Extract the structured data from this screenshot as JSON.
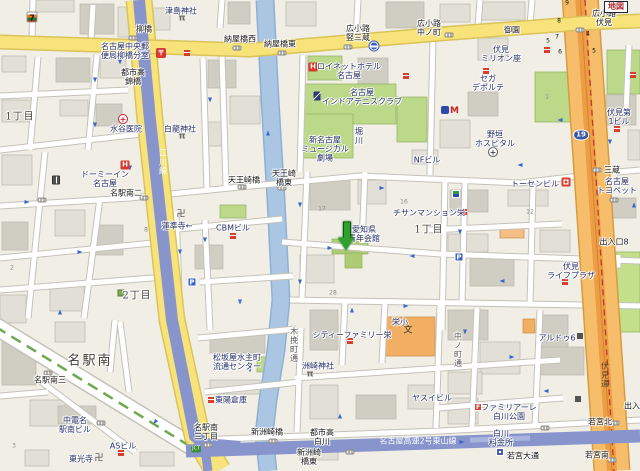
{
  "map": {
    "type": "japanese-street-map",
    "colors": {
      "background": "#F1EEE6",
      "building": "#E2E0D6",
      "building_dark": "#D0CEC3",
      "road_major_yellow": "#F8E27A",
      "road_route19_orange": "#F6BE6A",
      "road_route19_core": "#EE9D45",
      "river_blue": "#ABC6E2",
      "expressway_blue": "#8795CC",
      "park_green": "#BCD98A",
      "school_orange": "#F2AE62",
      "marker_green": "#2FA12F",
      "boundary_red": "#C0392B",
      "oneway_arrow_blue": "#3A66CC"
    },
    "marker": {
      "x": 347,
      "y": 237,
      "points_to": "愛知県青年会館"
    },
    "labels": [
      {
        "t": "1丁目",
        "x": 20,
        "y": 117,
        "c": "area"
      },
      {
        "t": "2丁目",
        "x": 137,
        "y": 296,
        "c": "area"
      },
      {
        "t": "名駅南",
        "x": 90,
        "y": 361,
        "c": "area-lg"
      },
      {
        "t": "1丁目",
        "x": 429,
        "y": 230,
        "c": "area"
      },
      {
        "t": "柳橋",
        "x": 144,
        "y": 29,
        "c": "xing"
      },
      {
        "t": "納屋橋西",
        "x": 240,
        "y": 39,
        "c": "xing"
      },
      {
        "t": "納屋橋東",
        "x": 280,
        "y": 44,
        "c": "xing"
      },
      {
        "t": "広小路\n竪三蔵",
        "x": 358,
        "y": 33,
        "c": "xing"
      },
      {
        "t": "広小路\n中ノ町",
        "x": 429,
        "y": 28,
        "c": "xing"
      },
      {
        "t": "広小路\n伏見",
        "x": 604,
        "y": 18,
        "c": "xing"
      },
      {
        "t": "御園",
        "x": 512,
        "y": 30,
        "c": "xing"
      },
      {
        "t": "名駅南二",
        "x": 126,
        "y": 193,
        "c": "xing"
      },
      {
        "t": "天王崎橋",
        "x": 244,
        "y": 180,
        "c": "xing"
      },
      {
        "t": "天王崎\n橋東",
        "x": 284,
        "y": 178,
        "c": "xing"
      },
      {
        "t": "三蔵",
        "x": 612,
        "y": 170,
        "c": "xing"
      },
      {
        "t": "名駅南三",
        "x": 50,
        "y": 380,
        "c": "xing"
      },
      {
        "t": "名駅南\n三丁目",
        "x": 206,
        "y": 432,
        "c": "xing"
      },
      {
        "t": "新洲崎橋",
        "x": 267,
        "y": 432,
        "c": "xing"
      },
      {
        "t": "新洲崎\n橋東",
        "x": 309,
        "y": 457,
        "c": "xing"
      },
      {
        "t": "若宮北",
        "x": 600,
        "y": 422,
        "c": "xing"
      },
      {
        "t": "若宮南",
        "x": 597,
        "y": 455,
        "c": "xing"
      },
      {
        "t": "出入口8",
        "x": 614,
        "y": 242,
        "c": "xing"
      },
      {
        "t": "出入口",
        "x": 636,
        "y": 406,
        "c": "xing"
      },
      {
        "t": "若宮大通",
        "x": 523,
        "y": 456,
        "c": "xing"
      },
      {
        "t": "都市高\n白川",
        "x": 322,
        "y": 437,
        "c": "xing"
      },
      {
        "t": "都市高\n錦橋",
        "x": 133,
        "y": 77,
        "c": "xing"
      },
      {
        "t": "津島神社",
        "x": 181,
        "y": 11,
        "c": "poi"
      },
      {
        "t": "名古屋中央郵\n便局柳橋分室",
        "x": 125,
        "y": 51,
        "c": "poi"
      },
      {
        "t": "水谷医院",
        "x": 126,
        "y": 129,
        "c": "poi"
      },
      {
        "t": "白龍神社",
        "x": 180,
        "y": 129,
        "c": "poi"
      },
      {
        "t": "ドーミーイン\n名古屋",
        "x": 105,
        "y": 179,
        "c": "poi"
      },
      {
        "t": "蓮準寺←",
        "x": 177,
        "y": 226,
        "c": "poi"
      },
      {
        "t": "CBMビル",
        "x": 233,
        "y": 228,
        "c": "poi"
      },
      {
        "t": "ロイネットホテル\n名古屋",
        "x": 349,
        "y": 71,
        "c": "poi"
      },
      {
        "t": "名古屋\nインドアテニスクラブ",
        "x": 362,
        "y": 97,
        "c": "poi"
      },
      {
        "t": "新名古屋\nミュージカル\n劇場",
        "x": 325,
        "y": 149,
        "c": "poi"
      },
      {
        "t": "NFビル",
        "x": 427,
        "y": 160,
        "c": "poi"
      },
      {
        "t": "チサンマンション栄",
        "x": 429,
        "y": 213,
        "c": "poi"
      },
      {
        "t": "愛知県\n青年会館",
        "x": 364,
        "y": 234,
        "c": "poi"
      },
      {
        "t": "伏見\nミリオン座",
        "x": 501,
        "y": 54,
        "c": "poi"
      },
      {
        "t": "セガ\nデポルテ",
        "x": 488,
        "y": 83,
        "c": "poi"
      },
      {
        "t": "野垣\nホスピタル",
        "x": 495,
        "y": 139,
        "c": "poi"
      },
      {
        "t": "伏見第\n1ビル",
        "x": 619,
        "y": 117,
        "c": "poi"
      },
      {
        "t": "名古屋\nトヨペット",
        "x": 617,
        "y": 186,
        "c": "poi"
      },
      {
        "t": "トーセンビル",
        "x": 535,
        "y": 184,
        "c": "poi"
      },
      {
        "t": "伏見\nライフプラザ",
        "x": 571,
        "y": 271,
        "c": "poi"
      },
      {
        "t": "ヤスイビル",
        "x": 432,
        "y": 398,
        "c": "poi"
      },
      {
        "t": "アルドゥ6",
        "x": 557,
        "y": 338,
        "c": "poi"
      },
      {
        "t": "ファミリアーレ\n白川公園",
        "x": 509,
        "y": 412,
        "c": "poi"
      },
      {
        "t": "シティーファミリー栄",
        "x": 352,
        "y": 335,
        "c": "poi"
      },
      {
        "t": "洲崎神社",
        "x": 318,
        "y": 366,
        "c": "poi"
      },
      {
        "t": "松坂屋水主町\n流通センター",
        "x": 237,
        "y": 362,
        "c": "poi"
      },
      {
        "t": "東陽倉庫",
        "x": 231,
        "y": 400,
        "c": "poi"
      },
      {
        "t": "東光寺",
        "x": 81,
        "y": 459,
        "c": "poi"
      },
      {
        "t": "ASビル",
        "x": 123,
        "y": 446,
        "c": "poi"
      },
      {
        "t": "中電名\n駅南ビル",
        "x": 75,
        "y": 425,
        "c": "poi"
      },
      {
        "t": "栄小",
        "x": 400,
        "y": 322,
        "c": "poi"
      },
      {
        "t": "白川\n料金所",
        "x": 501,
        "y": 438,
        "c": "poi"
      },
      {
        "t": "文",
        "x": 408,
        "y": 331,
        "c": "schoolsym"
      },
      {
        "t": "江川線",
        "x": 163,
        "y": 162,
        "c": "vroad-white"
      },
      {
        "t": "名古屋高速2号東山線",
        "x": 418,
        "y": 441,
        "c": "road-white"
      },
      {
        "t": "木挽町通",
        "x": 294,
        "y": 345,
        "c": "vroad"
      },
      {
        "t": "中ノ町通",
        "x": 458,
        "y": 350,
        "c": "vroad"
      },
      {
        "t": "伏見通",
        "x": 605,
        "y": 375,
        "c": "vroad-dk"
      },
      {
        "t": "堀川",
        "x": 359,
        "y": 136,
        "c": "vpoi"
      },
      {
        "t": "地図",
        "x": 616,
        "y": 7,
        "c": "mapbox"
      },
      {
        "t": "19",
        "x": 581,
        "y": 135,
        "c": "shield"
      },
      {
        "t": "JCT",
        "x": 196,
        "y": 449,
        "c": "jct"
      },
      {
        "t": "9",
        "x": 567,
        "y": 3,
        "c": "exitnum"
      },
      {
        "t": "8",
        "x": 559,
        "y": 21,
        "c": "exitnum"
      },
      {
        "t": "7",
        "x": 557,
        "y": 37,
        "c": "exitnum"
      },
      {
        "t": "5",
        "x": 548,
        "y": 41,
        "c": "exitnum"
      },
      {
        "t": "6",
        "x": 560,
        "y": 52,
        "c": "exitnum"
      },
      {
        "t": "4",
        "x": 588,
        "y": 34,
        "c": "exitnum"
      },
      {
        "t": "5",
        "x": 594,
        "y": 51,
        "c": "exitnum"
      },
      {
        "t": "17",
        "x": 322,
        "y": 209,
        "c": "bldgnum"
      },
      {
        "t": "16",
        "x": 404,
        "y": 202,
        "c": "bldgnum"
      },
      {
        "t": "28",
        "x": 333,
        "y": 293,
        "c": "bldgnum"
      },
      {
        "t": "8",
        "x": 146,
        "y": 230,
        "c": "bldgnum"
      },
      {
        "t": "2",
        "x": 12,
        "y": 268,
        "c": "bldgnum"
      },
      {
        "t": "3",
        "x": 14,
        "y": 446,
        "c": "bldgnum"
      },
      {
        "t": "12",
        "x": 530,
        "y": 212,
        "c": "bldgnum"
      },
      {
        "t": "1",
        "x": 547,
        "y": 97,
        "c": "bldgnum"
      }
    ],
    "icons": [
      {
        "n": "seven-eleven-icon",
        "k": "seven",
        "g": "7",
        "x": 32,
        "y": 17
      },
      {
        "n": "post-office-icon",
        "k": "post",
        "g": "〒",
        "x": 161,
        "y": 53
      },
      {
        "n": "post-office-icon",
        "k": "redpoi",
        "x": 187,
        "y": 53
      },
      {
        "n": "hospital-icon",
        "k": "hosp",
        "g": "+",
        "x": 123,
        "y": 119
      },
      {
        "n": "hospital-icon",
        "k": "hospd",
        "g": "+",
        "x": 493,
        "y": 152
      },
      {
        "n": "torii-icon",
        "k": "torii",
        "g": "π",
        "x": 182,
        "y": 19
      },
      {
        "n": "torii-icon",
        "k": "torii",
        "g": "π",
        "x": 182,
        "y": 137
      },
      {
        "n": "torii-icon",
        "k": "torii",
        "g": "π",
        "x": 310,
        "y": 375
      },
      {
        "n": "temple-manji-icon",
        "k": "manji",
        "g": "卍",
        "x": 181,
        "y": 215
      },
      {
        "n": "temple-manji-icon",
        "k": "manji",
        "g": "卍",
        "x": 99,
        "y": 459
      },
      {
        "n": "hotel-icon",
        "k": "hotel",
        "g": "H",
        "x": 313,
        "y": 67
      },
      {
        "n": "hotel-icon",
        "k": "hotel",
        "g": "H",
        "x": 125,
        "y": 165
      },
      {
        "n": "tennis-icon",
        "k": "tennis",
        "x": 317,
        "y": 96
      },
      {
        "n": "gas-station-icon",
        "k": "gas",
        "x": 56,
        "y": 180
      },
      {
        "n": "parking-icon",
        "k": "park",
        "g": "P",
        "x": 192,
        "y": 282
      },
      {
        "n": "parking-icon",
        "k": "park",
        "g": "P",
        "x": 459,
        "y": 257
      },
      {
        "n": "bus-stop-icon",
        "k": "bus",
        "x": 374,
        "y": 46
      },
      {
        "n": "subway-logo-icon",
        "k": "metro",
        "g": "M",
        "x": 450,
        "y": 111
      },
      {
        "n": "convenience-store-icon",
        "k": "conv",
        "x": 456,
        "y": 194
      },
      {
        "n": "poi-dot-icon",
        "k": "redpoi",
        "x": 233,
        "y": 236
      },
      {
        "n": "poi-dot-icon",
        "k": "redpoi",
        "x": 486,
        "y": 71
      },
      {
        "n": "poi-dot-icon",
        "k": "redpoi",
        "x": 617,
        "y": 129
      },
      {
        "n": "poi-dot-icon",
        "k": "redpoi",
        "x": 565,
        "y": 282
      },
      {
        "n": "poi-dot-icon",
        "k": "redpoi",
        "x": 350,
        "y": 341
      },
      {
        "n": "poi-dot-icon",
        "k": "redpoi",
        "x": 211,
        "y": 400
      },
      {
        "n": "poi-dot-icon",
        "k": "redpoi",
        "x": 121,
        "y": 453
      },
      {
        "n": "poi-dot-icon",
        "k": "redpoi",
        "x": 547,
        "y": 50
      },
      {
        "n": "poi-dot-icon",
        "k": "redpoi",
        "x": 633,
        "y": 75
      },
      {
        "n": "poi-dot-icon",
        "k": "redpoi",
        "x": 406,
        "y": 76
      },
      {
        "n": "poi-dot-icon",
        "k": "redpoi",
        "x": 464,
        "y": 212
      },
      {
        "n": "fire-station-icon",
        "k": "fire",
        "x": 566,
        "y": 182
      },
      {
        "n": "residence-logo-icon",
        "k": "fam",
        "g": "F",
        "x": 478,
        "y": 407
      },
      {
        "n": "company-logo-icon",
        "k": "darkco",
        "x": 580,
        "y": 336
      },
      {
        "n": "company-logo-icon",
        "k": "darkco",
        "x": 578,
        "y": 399
      },
      {
        "n": "toll-gate-icon",
        "k": "toll",
        "x": 500,
        "y": 452
      },
      {
        "n": "park-square-icon",
        "k": "greenpark",
        "x": 121,
        "y": 293
      },
      {
        "n": "signal-icon",
        "k": "signal",
        "x": 133,
        "y": 38
      },
      {
        "n": "signal-icon",
        "k": "signal",
        "x": 237,
        "y": 48
      },
      {
        "n": "signal-icon",
        "k": "signal",
        "x": 282,
        "y": 53
      },
      {
        "n": "signal-icon",
        "k": "signal",
        "x": 348,
        "y": 47
      },
      {
        "n": "signal-icon",
        "k": "signal",
        "x": 449,
        "y": 35
      },
      {
        "n": "signal-icon",
        "k": "signal",
        "x": 580,
        "y": 30
      },
      {
        "n": "signal-icon",
        "k": "signal",
        "x": 42,
        "y": 200
      },
      {
        "n": "signal-icon",
        "k": "signal",
        "x": 144,
        "y": 198
      },
      {
        "n": "signal-icon",
        "k": "signal",
        "x": 242,
        "y": 187
      },
      {
        "n": "signal-icon",
        "k": "signal",
        "x": 282,
        "y": 188
      },
      {
        "n": "signal-icon",
        "k": "signal",
        "x": 597,
        "y": 170
      },
      {
        "n": "signal-icon",
        "k": "signal",
        "x": 48,
        "y": 373
      },
      {
        "n": "signal-icon",
        "k": "signal",
        "x": 208,
        "y": 445
      },
      {
        "n": "signal-icon",
        "k": "signal",
        "x": 273,
        "y": 441
      },
      {
        "n": "signal-icon",
        "k": "signal",
        "x": 350,
        "y": 452
      },
      {
        "n": "signal-icon",
        "k": "signal",
        "x": 545,
        "y": 428
      },
      {
        "n": "signal-icon",
        "k": "signal",
        "x": 615,
        "y": 423
      },
      {
        "n": "signal-icon",
        "k": "signal",
        "x": 612,
        "y": 460
      },
      {
        "n": "signal-icon",
        "k": "signal",
        "x": 101,
        "y": 423
      },
      {
        "n": "signal-icon",
        "k": "signal",
        "x": 614,
        "y": 200
      }
    ],
    "arrows": [
      {
        "x": 120,
        "y": 62,
        "r": 90
      },
      {
        "x": 95,
        "y": 125,
        "r": 90
      },
      {
        "x": 210,
        "y": 100,
        "r": 90
      },
      {
        "x": 268,
        "y": 133,
        "r": 270
      },
      {
        "x": 130,
        "y": 168,
        "r": 90
      },
      {
        "x": 27,
        "y": 202,
        "r": 0
      },
      {
        "x": 80,
        "y": 252,
        "r": 0
      },
      {
        "x": 60,
        "y": 312,
        "r": 270
      },
      {
        "x": 180,
        "y": 252,
        "r": 90
      },
      {
        "x": 240,
        "y": 302,
        "r": 90
      },
      {
        "x": 300,
        "y": 205,
        "r": 90
      },
      {
        "x": 382,
        "y": 188,
        "r": 0
      },
      {
        "x": 330,
        "y": 248,
        "r": 0
      },
      {
        "x": 412,
        "y": 256,
        "r": 180
      },
      {
        "x": 300,
        "y": 282,
        "r": 90
      },
      {
        "x": 352,
        "y": 310,
        "r": 270
      },
      {
        "x": 406,
        "y": 306,
        "r": 0
      },
      {
        "x": 460,
        "y": 232,
        "r": 90
      },
      {
        "x": 502,
        "y": 281,
        "r": 180
      },
      {
        "x": 465,
        "y": 332,
        "r": 90
      },
      {
        "x": 512,
        "y": 357,
        "r": 0
      },
      {
        "x": 546,
        "y": 391,
        "r": 180
      },
      {
        "x": 462,
        "y": 442,
        "r": 0
      },
      {
        "x": 340,
        "y": 416,
        "r": 270
      },
      {
        "x": 610,
        "y": 142,
        "r": 90
      },
      {
        "x": 634,
        "y": 205,
        "r": 270
      },
      {
        "x": 155,
        "y": 422,
        "r": 130
      },
      {
        "x": 250,
        "y": 370,
        "r": 90
      },
      {
        "x": 205,
        "y": 240,
        "r": 90
      },
      {
        "x": 560,
        "y": 120,
        "r": 180
      },
      {
        "x": 520,
        "y": 165,
        "r": 180
      },
      {
        "x": 95,
        "y": 80,
        "r": 90
      }
    ]
  }
}
